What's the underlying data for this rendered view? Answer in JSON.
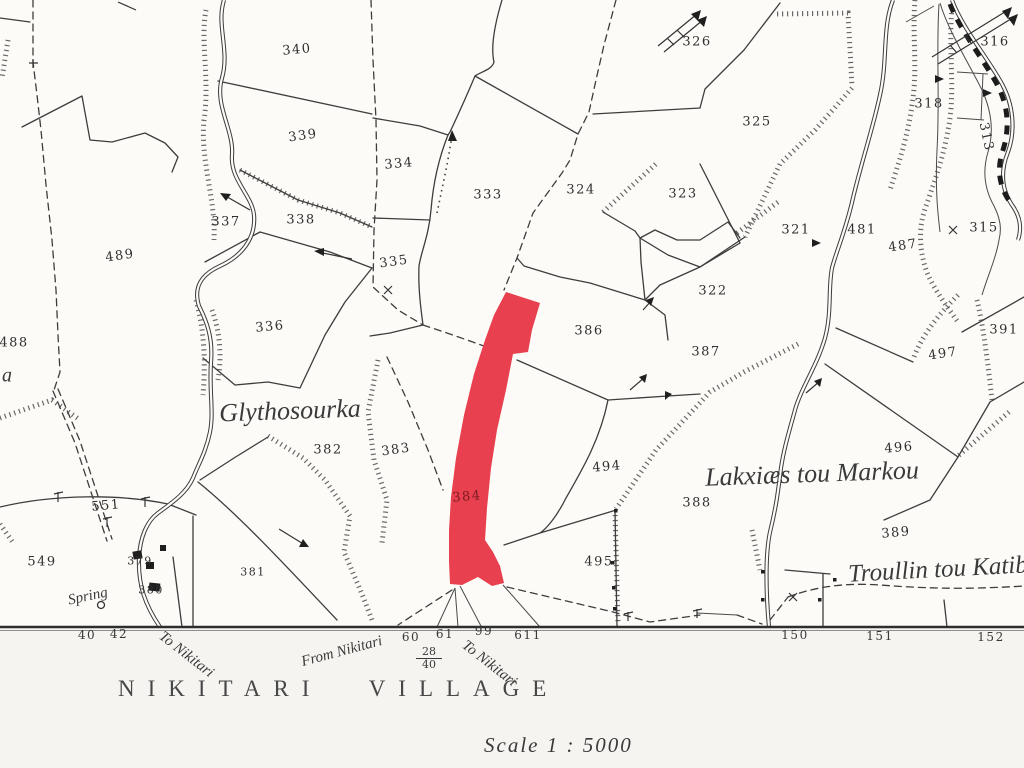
{
  "map": {
    "title": "NIKITARI  VILLAGE",
    "scale_label": "Scale 1 : 5000",
    "highlight_color": "#e8404e",
    "highlight_text_color": "#7d1a22",
    "highlighted_parcel": "384",
    "ink_color": "#3d3d3d",
    "parcel_labels": [
      {
        "t": "340",
        "x": 297,
        "y": 50,
        "r": -5
      },
      {
        "t": "339",
        "x": 303,
        "y": 136,
        "r": -8
      },
      {
        "t": "337",
        "x": 226,
        "y": 222,
        "r": 0
      },
      {
        "t": "338",
        "x": 301,
        "y": 220,
        "r": 0
      },
      {
        "t": "334",
        "x": 399,
        "y": 164,
        "r": -5
      },
      {
        "t": "333",
        "x": 488,
        "y": 195,
        "r": 0
      },
      {
        "t": "335",
        "x": 394,
        "y": 262,
        "r": -8
      },
      {
        "t": "324",
        "x": 581,
        "y": 190,
        "r": 0
      },
      {
        "t": "323",
        "x": 683,
        "y": 194,
        "r": 0
      },
      {
        "t": "326",
        "x": 697,
        "y": 42,
        "r": 0
      },
      {
        "t": "325",
        "x": 757,
        "y": 122,
        "r": 0
      },
      {
        "t": "321",
        "x": 796,
        "y": 230,
        "r": 0
      },
      {
        "t": "481",
        "x": 862,
        "y": 230,
        "r": 0
      },
      {
        "t": "487",
        "x": 903,
        "y": 246,
        "r": -8
      },
      {
        "t": "318",
        "x": 929,
        "y": 104,
        "r": 0
      },
      {
        "t": "316",
        "x": 995,
        "y": 42,
        "r": 0
      },
      {
        "t": "313",
        "x": 986,
        "y": 137,
        "r": 78
      },
      {
        "t": "315",
        "x": 984,
        "y": 228,
        "r": 0
      },
      {
        "t": "391",
        "x": 1004,
        "y": 330,
        "r": 0
      },
      {
        "t": "497",
        "x": 943,
        "y": 354,
        "r": -8
      },
      {
        "t": "496",
        "x": 899,
        "y": 448,
        "r": -5
      },
      {
        "t": "389",
        "x": 896,
        "y": 533,
        "r": -5
      },
      {
        "t": "322",
        "x": 713,
        "y": 291,
        "r": 0
      },
      {
        "t": "387",
        "x": 706,
        "y": 352,
        "r": 0
      },
      {
        "t": "386",
        "x": 589,
        "y": 331,
        "r": 0
      },
      {
        "t": "494",
        "x": 607,
        "y": 467,
        "r": -5
      },
      {
        "t": "495",
        "x": 599,
        "y": 562,
        "r": 0
      },
      {
        "t": "388",
        "x": 697,
        "y": 503,
        "r": 0
      },
      {
        "t": "383",
        "x": 396,
        "y": 450,
        "r": -8
      },
      {
        "t": "382",
        "x": 328,
        "y": 450,
        "r": 0
      },
      {
        "t": "336",
        "x": 270,
        "y": 327,
        "r": -5
      },
      {
        "t": "489",
        "x": 120,
        "y": 256,
        "r": -8
      },
      {
        "t": "488",
        "x": 14,
        "y": 343,
        "r": 0
      },
      {
        "t": "551",
        "x": 106,
        "y": 506,
        "r": -5
      },
      {
        "t": "549",
        "x": 42,
        "y": 562,
        "r": 0
      },
      {
        "t": "379",
        "x": 140,
        "y": 561,
        "r": 0,
        "s": 11
      },
      {
        "t": "380",
        "x": 151,
        "y": 590,
        "r": 0,
        "s": 11
      },
      {
        "t": "381",
        "x": 253,
        "y": 572,
        "r": 0,
        "s": 11
      },
      {
        "t": "384",
        "x": 467,
        "y": 497,
        "r": -5,
        "c": "#7d1a22"
      }
    ],
    "road_numbers": [
      {
        "t": "40",
        "x": 87,
        "y": 635
      },
      {
        "t": "42",
        "x": 119,
        "y": 634
      },
      {
        "t": "60",
        "x": 411,
        "y": 637
      },
      {
        "t": "61",
        "x": 445,
        "y": 634
      },
      {
        "t": "99",
        "x": 484,
        "y": 631
      },
      {
        "t": "611",
        "x": 528,
        "y": 635
      },
      {
        "t": "150",
        "x": 795,
        "y": 635
      },
      {
        "t": "151",
        "x": 880,
        "y": 636
      },
      {
        "t": "152",
        "x": 991,
        "y": 637
      }
    ],
    "place_names": [
      {
        "t": "Glythosourka",
        "x": 290,
        "y": 411,
        "r": -2,
        "s": 26
      },
      {
        "t": "Lakxiæs  tou  Markou",
        "x": 812,
        "y": 474,
        "r": -2,
        "s": 26
      },
      {
        "t": "Troullin tou Katib",
        "x": 938,
        "y": 570,
        "r": -3,
        "s": 25
      },
      {
        "t": "Spring",
        "x": 88,
        "y": 597,
        "r": -12,
        "s": 15
      },
      {
        "t": "a",
        "x": 7,
        "y": 376,
        "r": 0,
        "s": 20
      }
    ],
    "road_labels": [
      {
        "t": "To Nikitari",
        "x": 186,
        "y": 655,
        "r": 38
      },
      {
        "t": "From Nikitari",
        "x": 342,
        "y": 652,
        "r": -15
      },
      {
        "t": "To Nikitari",
        "x": 489,
        "y": 664,
        "r": 38
      }
    ],
    "fraction": {
      "top": "28",
      "bottom": "40"
    }
  }
}
